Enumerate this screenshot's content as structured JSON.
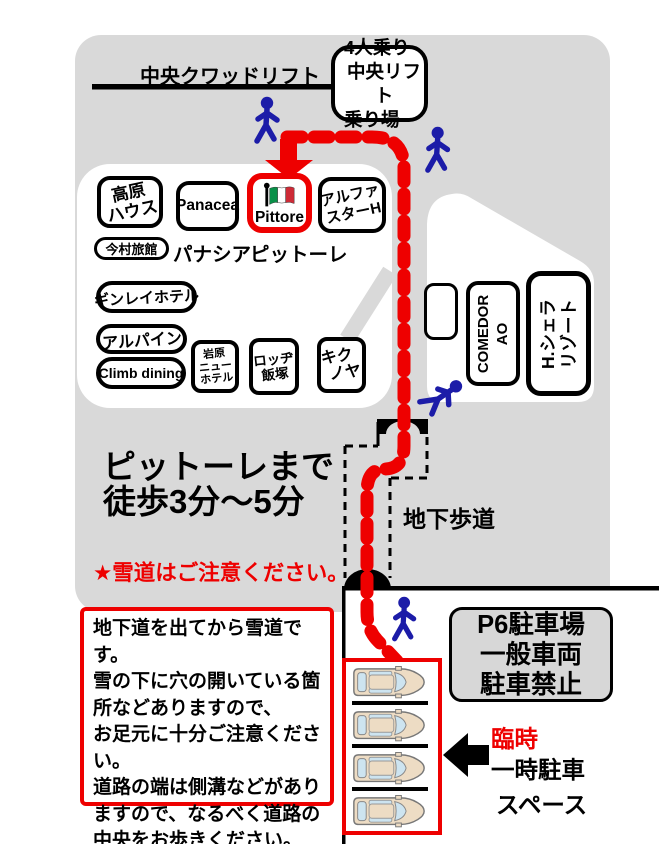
{
  "lift": {
    "line_label": "中央クワッドリフト",
    "station_line1": "4人乗り",
    "station_line2": "中央リフト",
    "station_line3": "乗り場"
  },
  "buildings": {
    "kogen_line1": "高原",
    "kogen_line2": "ハウス",
    "panacea_box": "Panacea",
    "pittore_box": "Pittore",
    "alpha_line1": "アルファ",
    "alpha_line2": "スターH",
    "imamura": "今村旅館",
    "panacea_label": "パナシア",
    "pittore_label": "ピットーレ",
    "ginrei": "ギンレイホテル",
    "alpine": "アルパイン",
    "climb": "Climb dining",
    "iwappara_line1": "岩原",
    "iwappara_line2": "ニュー",
    "iwappara_line3": "ホテル",
    "lodge_line1": "ロッヂ",
    "lodge_line2": "飯塚",
    "kikuya_line1": "キク",
    "kikuya_line2": "ノヤ",
    "comedor_line1": "COMEDOR",
    "comedor_line2": "AO",
    "sierra_line1": "H.シェラ",
    "sierra_line2": "リゾート"
  },
  "notes": {
    "walk_line1": "ピットーレまで",
    "walk_line2": "徒歩3分～5分",
    "snow_caution": "★雪道はご注意ください。",
    "underpass_label": "地下歩道"
  },
  "warning_box": {
    "line1": "地下道を出てから雪道です。",
    "line2": "雪の下に穴の開いている箇",
    "line3": "所などありますので、",
    "line4": "お足元に十分ご注意ください。",
    "line5": "道路の端は側溝などがあり",
    "line6": "ますので、なるべく道路の",
    "line7": "中央をお歩きください。"
  },
  "parking": {
    "p6_line1": "P6駐車場",
    "p6_line2": "一般車両",
    "p6_line3": "駐車禁止",
    "temp_line1": "臨時",
    "temp_line2": "一時駐車",
    "temp_line3": "スペース",
    "cars_count": 4
  },
  "colors": {
    "route_red": "#ee0000",
    "person_blue": "#1c1ca8",
    "background_gray": "#d9d9d9",
    "flag_green": "#089048",
    "flag_red": "#ce2b37",
    "car_body": "#eddcc4",
    "car_window": "#cde4f0"
  }
}
